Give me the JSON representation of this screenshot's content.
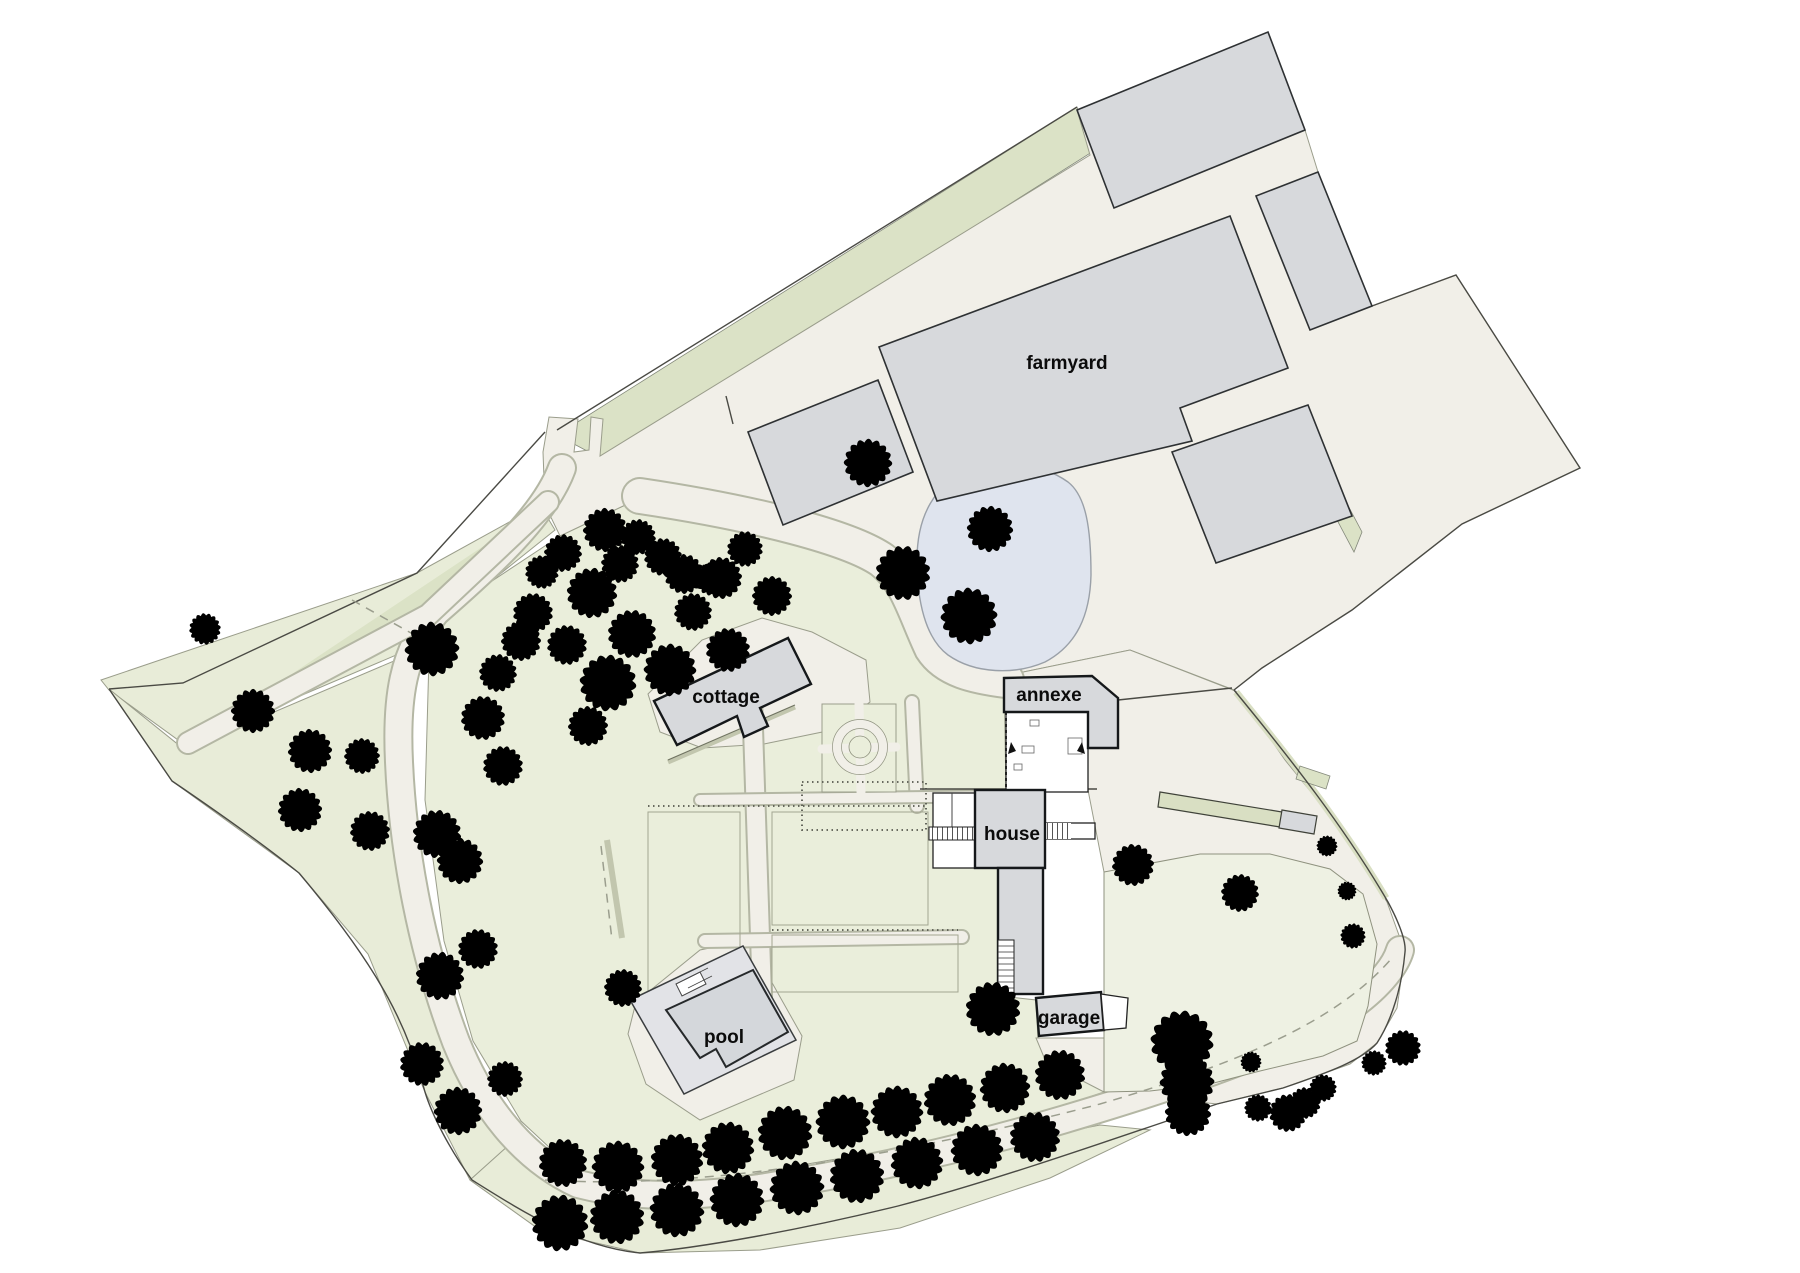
{
  "labels": {
    "farmyard": "farmyard",
    "cottage": "cottage",
    "annexe": "annexe",
    "house": "house",
    "garage": "garage",
    "pool": "pool"
  },
  "colors": {
    "bg": "#ffffff",
    "paving": "#f1efe8",
    "field": "#e8ecd8",
    "garden": "#eaeedb",
    "lawn": "#eef1e3",
    "hedge": "#dbe2c6",
    "building": "#d7d9dc",
    "building_outline": "#15181a",
    "pond": "#dfe4ee",
    "boundary": "#4a4a44",
    "path_edge": "#9a9d8b",
    "tree_light": "#d8e0b4",
    "tree_pale": "#edefe0",
    "tree_gray": "#cdd1be",
    "tree_avenue": "#c6cab7",
    "tree_oak": "#bcc1ad"
  }
}
